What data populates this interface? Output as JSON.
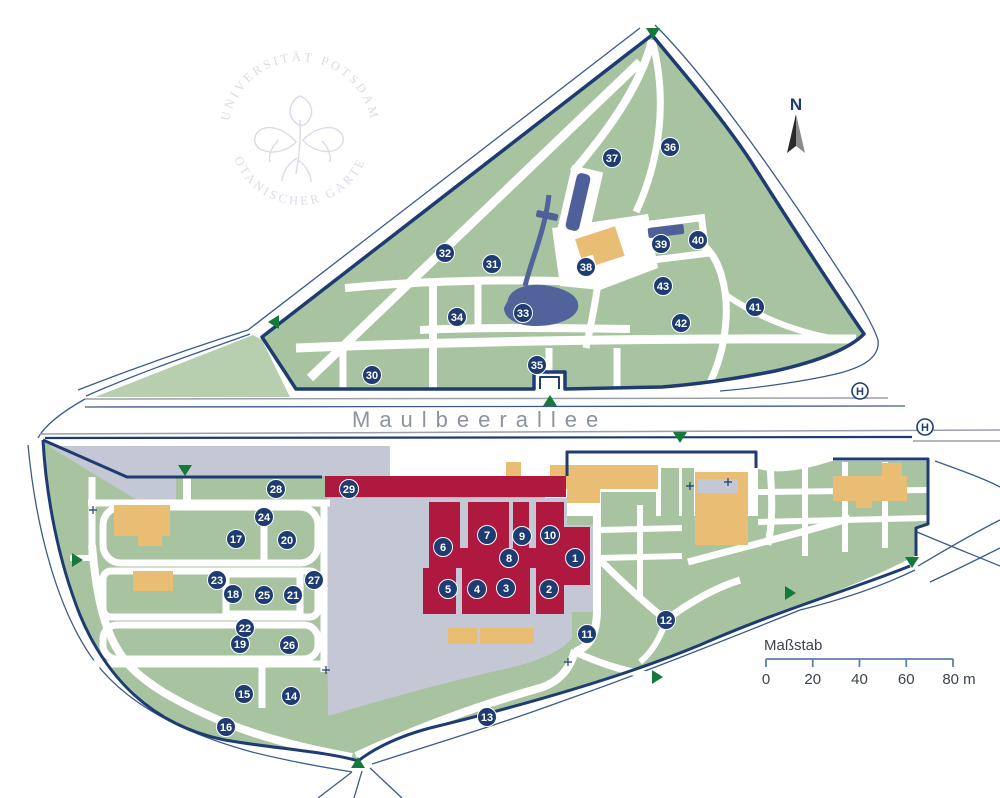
{
  "map": {
    "street_name": "Maulbeerallee",
    "north_label": "N",
    "bus_stop_label": "H",
    "logo": {
      "top_text": "UNIVERSITÄT POTSDAM",
      "bottom_text": "• BOTANISCHER GARTEN •"
    },
    "scalebar": {
      "label": "Maßstab",
      "ticks": [
        "0",
        "20",
        "40",
        "60",
        "80 m"
      ]
    },
    "markers": [
      {
        "n": 1,
        "x": 575,
        "y": 558
      },
      {
        "n": 2,
        "x": 549,
        "y": 589
      },
      {
        "n": 3,
        "x": 506,
        "y": 588
      },
      {
        "n": 4,
        "x": 477,
        "y": 589
      },
      {
        "n": 5,
        "x": 448,
        "y": 589
      },
      {
        "n": 6,
        "x": 443,
        "y": 547
      },
      {
        "n": 7,
        "x": 487,
        "y": 535
      },
      {
        "n": 8,
        "x": 509,
        "y": 558
      },
      {
        "n": 9,
        "x": 522,
        "y": 536
      },
      {
        "n": 10,
        "x": 550,
        "y": 535
      },
      {
        "n": 11,
        "x": 587,
        "y": 634
      },
      {
        "n": 12,
        "x": 666,
        "y": 620
      },
      {
        "n": 13,
        "x": 487,
        "y": 717
      },
      {
        "n": 14,
        "x": 291,
        "y": 696
      },
      {
        "n": 15,
        "x": 244,
        "y": 694
      },
      {
        "n": 16,
        "x": 226,
        "y": 727
      },
      {
        "n": 17,
        "x": 236,
        "y": 539
      },
      {
        "n": 18,
        "x": 233,
        "y": 594
      },
      {
        "n": 19,
        "x": 240,
        "y": 644
      },
      {
        "n": 20,
        "x": 287,
        "y": 540
      },
      {
        "n": 21,
        "x": 293,
        "y": 595
      },
      {
        "n": 22,
        "x": 245,
        "y": 628
      },
      {
        "n": 23,
        "x": 217,
        "y": 580
      },
      {
        "n": 24,
        "x": 264,
        "y": 517
      },
      {
        "n": 25,
        "x": 264,
        "y": 595
      },
      {
        "n": 26,
        "x": 289,
        "y": 645
      },
      {
        "n": 27,
        "x": 314,
        "y": 580
      },
      {
        "n": 28,
        "x": 276,
        "y": 489
      },
      {
        "n": 29,
        "x": 349,
        "y": 489
      },
      {
        "n": 30,
        "x": 372,
        "y": 375
      },
      {
        "n": 31,
        "x": 492,
        "y": 264
      },
      {
        "n": 32,
        "x": 445,
        "y": 253
      },
      {
        "n": 33,
        "x": 523,
        "y": 313
      },
      {
        "n": 34,
        "x": 457,
        "y": 317
      },
      {
        "n": 35,
        "x": 537,
        "y": 365
      },
      {
        "n": 36,
        "x": 670,
        "y": 147
      },
      {
        "n": 37,
        "x": 612,
        "y": 158
      },
      {
        "n": 38,
        "x": 586,
        "y": 267
      },
      {
        "n": 39,
        "x": 661,
        "y": 244
      },
      {
        "n": 40,
        "x": 698,
        "y": 240
      },
      {
        "n": 41,
        "x": 755,
        "y": 307
      },
      {
        "n": 42,
        "x": 681,
        "y": 323
      },
      {
        "n": 43,
        "x": 663,
        "y": 286
      }
    ],
    "bus_stops": [
      {
        "x": 860,
        "y": 391
      },
      {
        "x": 925,
        "y": 427
      }
    ],
    "entrances": [
      {
        "x": 653,
        "y": 33,
        "dir": "down"
      },
      {
        "x": 274,
        "y": 322,
        "dir": "left"
      },
      {
        "x": 550,
        "y": 401,
        "dir": "up"
      },
      {
        "x": 680,
        "y": 437,
        "dir": "down"
      },
      {
        "x": 185,
        "y": 470,
        "dir": "down"
      },
      {
        "x": 77,
        "y": 560,
        "dir": "right"
      },
      {
        "x": 358,
        "y": 763,
        "dir": "up"
      },
      {
        "x": 657,
        "y": 677,
        "dir": "right"
      },
      {
        "x": 912,
        "y": 562,
        "dir": "down"
      },
      {
        "x": 790,
        "y": 593,
        "dir": "right"
      }
    ],
    "gate_marks": [
      {
        "x": 93,
        "y": 510
      },
      {
        "x": 326,
        "y": 670
      },
      {
        "x": 568,
        "y": 662
      },
      {
        "x": 690,
        "y": 486
      },
      {
        "x": 728,
        "y": 482
      }
    ],
    "colors": {
      "green": "#a8c3a0",
      "green_light": "#b7cfae",
      "gray": "#c3c8d4",
      "navy": "#1f3c72",
      "road": "#3c5a8a",
      "road_gray": "#9aa0a8",
      "orange": "#e9bd74",
      "red": "#b0193f",
      "blue_building": "#4f5f9a",
      "pond": "#51639b",
      "entrance_green": "#15793b",
      "logo": "#d9dbe9",
      "text_gray": "#8d939e",
      "scale_text": "#3c434c",
      "scale_line": "#5b7fae",
      "arrow_dark": "#2a2a2a",
      "arrow_light": "#8a8a8a"
    }
  }
}
